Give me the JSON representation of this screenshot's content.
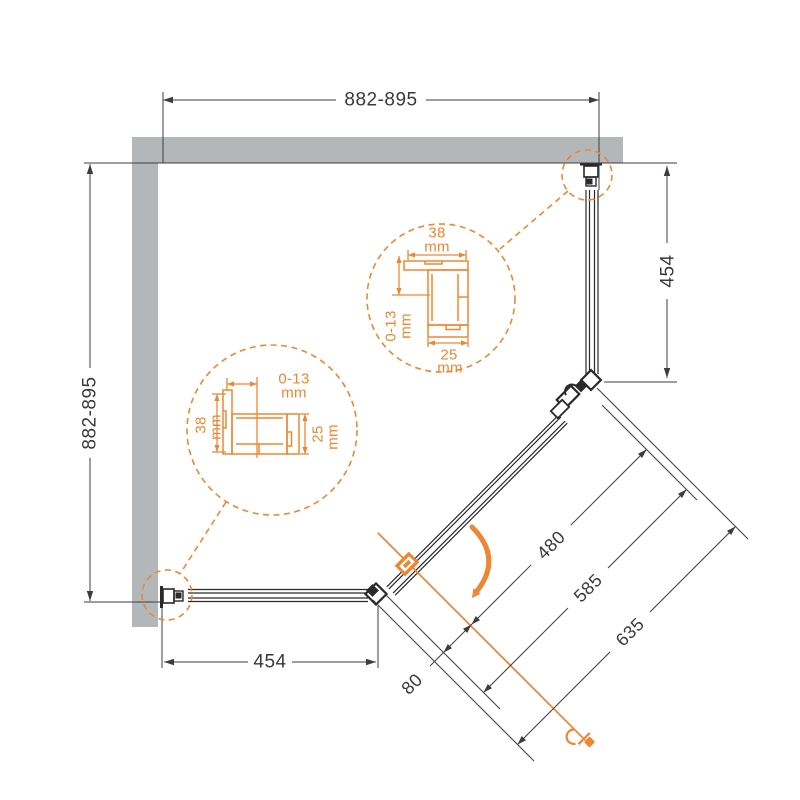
{
  "diagram": {
    "type": "shower-enclosure-plan-drawing",
    "dimensions": {
      "top_width": "882-895",
      "left_depth": "882-895",
      "right_panel_height": "454",
      "bottom_panel_width": "454",
      "door_glass_width": "480",
      "door_width": "585",
      "entry_width": "635",
      "corner_offset": "80"
    },
    "profile_detail": {
      "width_value": "38",
      "adjust_value": "0-13",
      "depth_value": "25",
      "unit": "mm"
    },
    "colors": {
      "accent": "#ED8733",
      "wall": "#B4B7B9",
      "line": "#3D3D3D"
    }
  }
}
